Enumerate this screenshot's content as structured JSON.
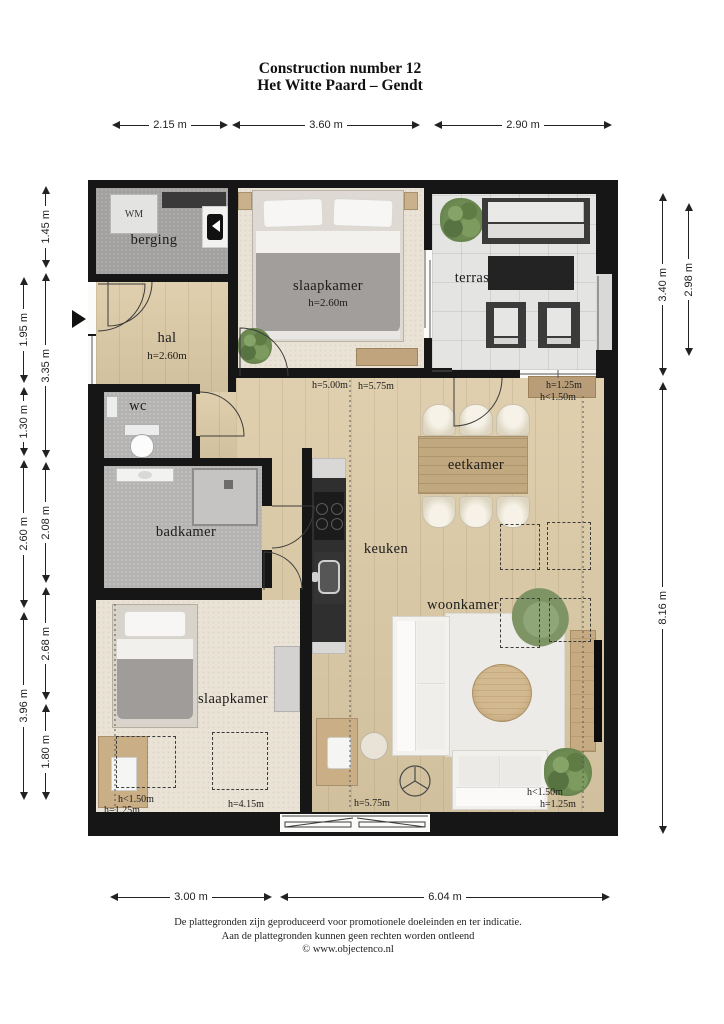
{
  "title": {
    "line1": "Construction number 12",
    "line2": "Het Witte Paard – Gendt"
  },
  "dims": {
    "top": [
      "2.15 m",
      "3.60 m",
      "2.90 m"
    ],
    "left_outer": [
      "1.95 m",
      "1.30 m",
      "2.60 m",
      "3.96 m"
    ],
    "left_inner": [
      "1.45 m",
      "3.35 m",
      "2.08 m",
      "2.68 m",
      "1.80 m"
    ],
    "right_inner": [
      "3.40 m",
      "8.16 m"
    ],
    "right_outer": [
      "2.98 m"
    ],
    "bottom": [
      "3.00 m",
      "6.04 m"
    ]
  },
  "rooms": {
    "berging": {
      "label": "berging"
    },
    "slaapkamer_top": {
      "label": "slaapkamer",
      "height": "h=2.60m"
    },
    "terras": {
      "label": "terras"
    },
    "hal": {
      "label": "hal",
      "height": "h=2.60m"
    },
    "wc": {
      "label": "wc"
    },
    "badkamer": {
      "label": "badkamer"
    },
    "keuken": {
      "label": "keuken"
    },
    "eetkamer": {
      "label": "eetkamer"
    },
    "woonkamer": {
      "label": "woonkamer"
    },
    "slaapkamer_bottom": {
      "label": "slaapkamer"
    }
  },
  "annotations": {
    "keuken_h1": "h=5.00m",
    "keuken_h2": "h=5.75m",
    "right_top_h1": "h=1.25m",
    "right_top_h2": "h<1.50m",
    "slk2_h1": "h<1.50m",
    "slk2_h2": "h=1.25m",
    "slk2_h3": "h=4.15m",
    "center_bottom_h": "h=5.75m",
    "right_bottom_h1": "h<1.50m",
    "right_bottom_h2": "h=1.25m"
  },
  "appliances": {
    "washer": "WM"
  },
  "footer": {
    "line1": "De plattegronden zijn geproduceerd voor promotionele doeleinden en ter indicatie.",
    "line2": "Aan de plattegronden kunnen geen rechten worden ontleend",
    "line3": "© www.objectenco.nl"
  },
  "colors": {
    "wall": "#161616",
    "wood_floor": "#dccaa5",
    "carpet": "#e9e2d5",
    "terrace_tile": "#e4e4e3",
    "wet_room_floor": "#b5b3b1",
    "storage_floor": "#a3a1a0",
    "table_wood": "#c2a87e",
    "plant_green": "#6d8a52",
    "dark_furniture": "#2e2e2e",
    "sofa_white": "#f3f2ef"
  }
}
